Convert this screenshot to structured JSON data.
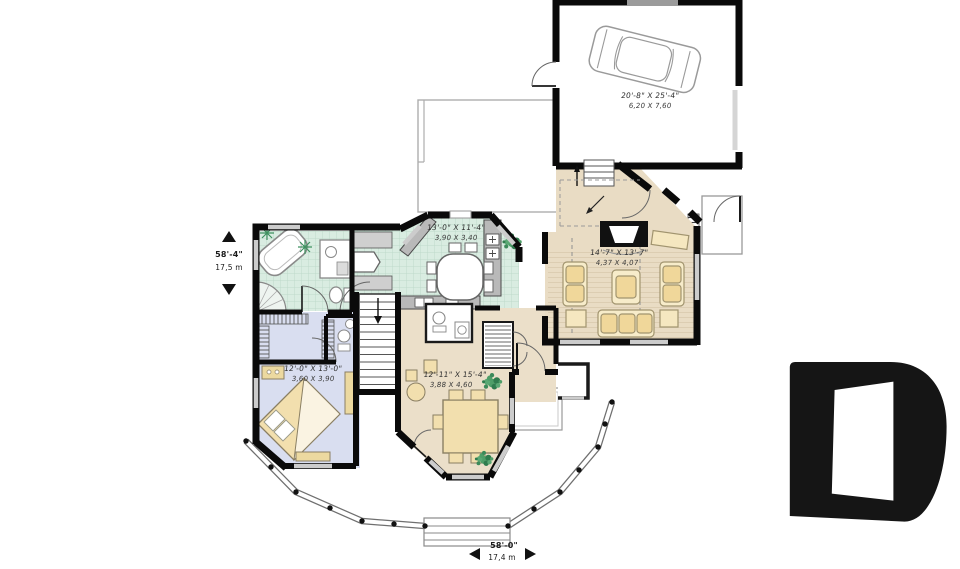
{
  "plan": {
    "title": "single-storey house first floor plan",
    "rooms": {
      "garage": {
        "imperial": "20'-8\" X 25'-4\"",
        "metric": "6,20 X 7,60"
      },
      "kitchen": {
        "imperial": "13'-0\" X 11'-4\"",
        "metric": "3,90 X 3,40"
      },
      "family_room": {
        "imperial": "14'-7\" X 13'-7\"",
        "metric": "4,37 X 4,07"
      },
      "bedroom": {
        "imperial": "12'-0\" X 13'-0\"",
        "metric": "3,60 X 3,90"
      },
      "dining_room": {
        "imperial": "12'-11\" X 15'-4\"",
        "metric": "3,88 X 4,60"
      }
    },
    "overall_dimensions": {
      "depth": {
        "imperial": "58'-4\"",
        "metric": "17,5 m"
      },
      "width": {
        "imperial": "58'-0\"",
        "metric": "17,4 m"
      }
    },
    "watermark": {
      "name": "drummond-d-logo",
      "color": "#151515"
    },
    "colors": {
      "wall": "#0a0a0a",
      "tile_floor": "#d9ece1",
      "tile_grid": "#bedacb",
      "carpet_floor": "#ebdfc9",
      "bedroom_floor": "#d9def0",
      "furniture_wood": "#f2dfae",
      "counter_gray": "#b9b9b9",
      "window_gray": "#cccccc",
      "plant_green": "#4e9e68"
    }
  }
}
